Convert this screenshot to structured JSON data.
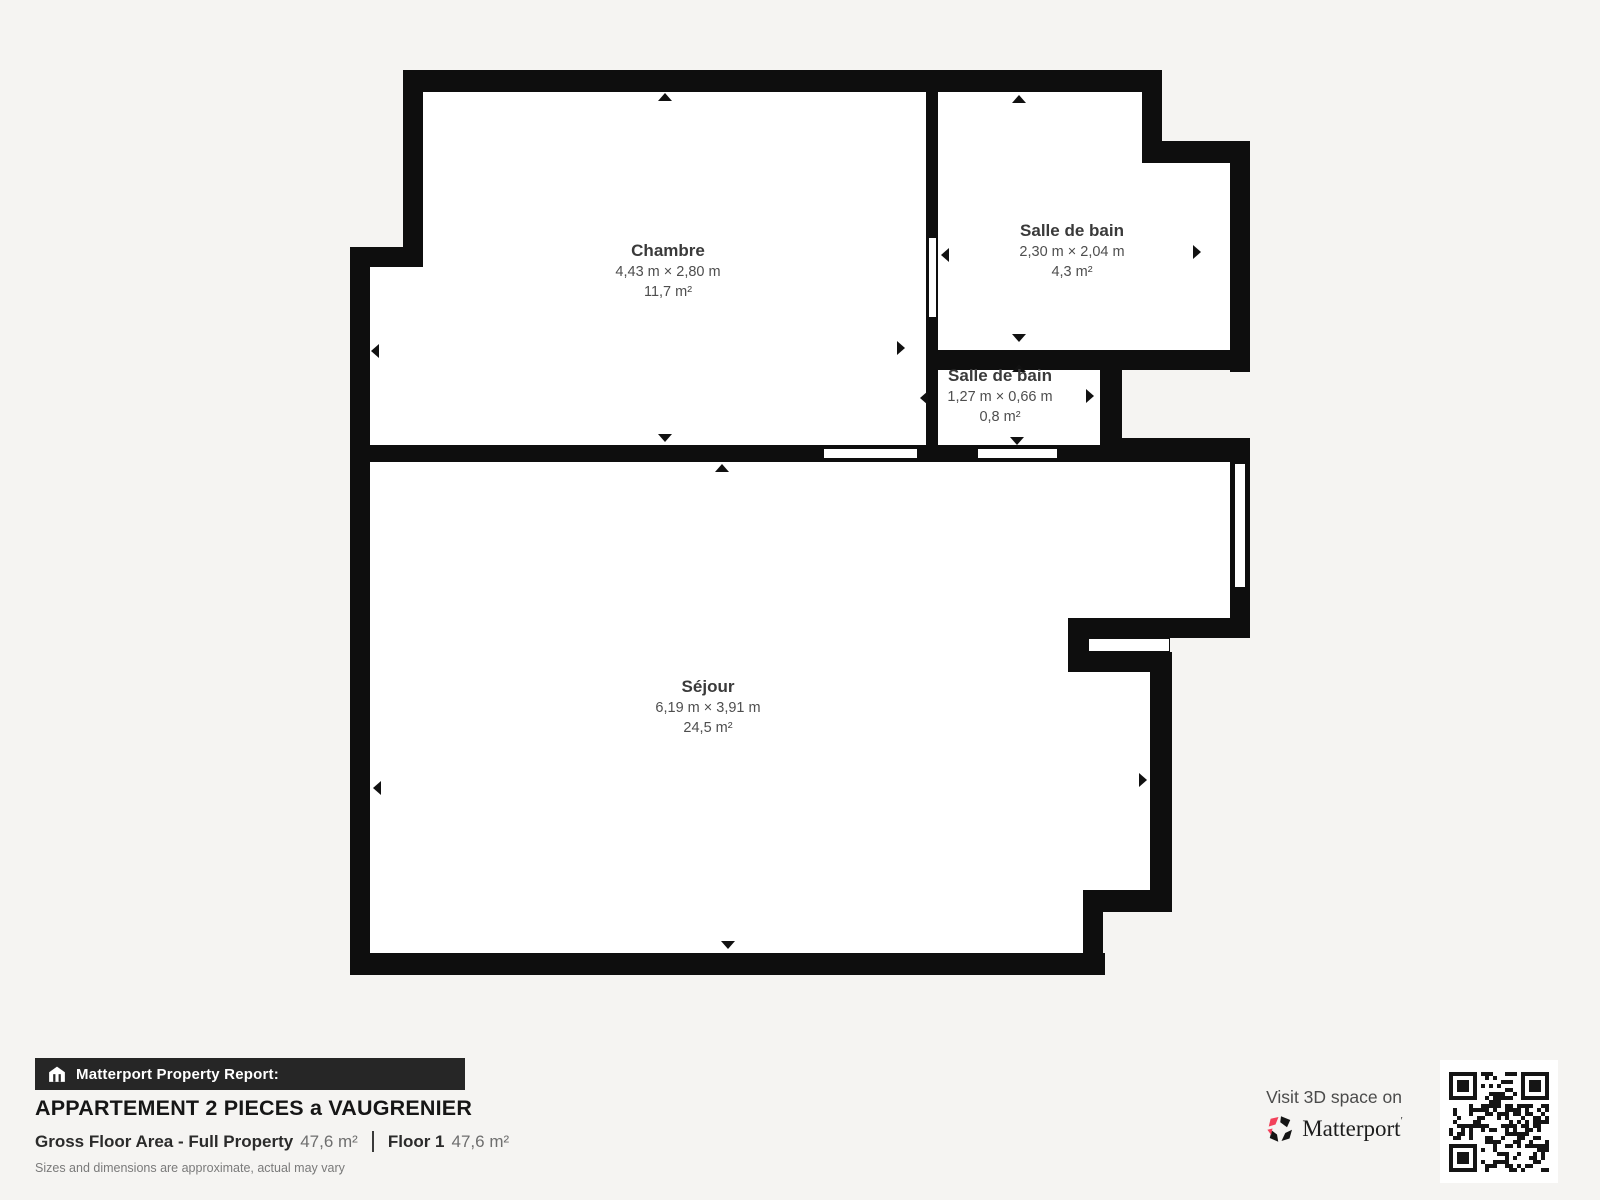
{
  "colors": {
    "background": "#f5f4f2",
    "wall": "#0e0e0e",
    "room_fill": "#ffffff",
    "brand_pink": "#f2415a"
  },
  "rooms": [
    {
      "name": "Chambre",
      "dimensions": "4,43 m × 2,80 m",
      "area": "11,7 m²"
    },
    {
      "name": "Salle de bain",
      "dimensions": "2,30 m × 2,04 m",
      "area": "4,3 m²"
    },
    {
      "name": "Salle de bain",
      "dimensions": "1,27 m × 0,66 m",
      "area": "0,8 m²"
    },
    {
      "name": "Séjour",
      "dimensions": "6,19 m × 3,91 m",
      "area": "24,5 m²"
    }
  ],
  "footer": {
    "banner": "Matterport Property Report:",
    "title": "APPARTEMENT 2 PIECES a VAUGRENIER",
    "gross_label": "Gross Floor Area - Full Property",
    "gross_value": "47,6 m²",
    "floor_label": "Floor 1",
    "floor_value": "47,6 m²",
    "disclaimer": "Sizes and dimensions are approximate, actual may vary"
  },
  "cta": {
    "visit_text": "Visit 3D space on",
    "brand": "Matterport",
    "brand_mark": "ʹ"
  }
}
